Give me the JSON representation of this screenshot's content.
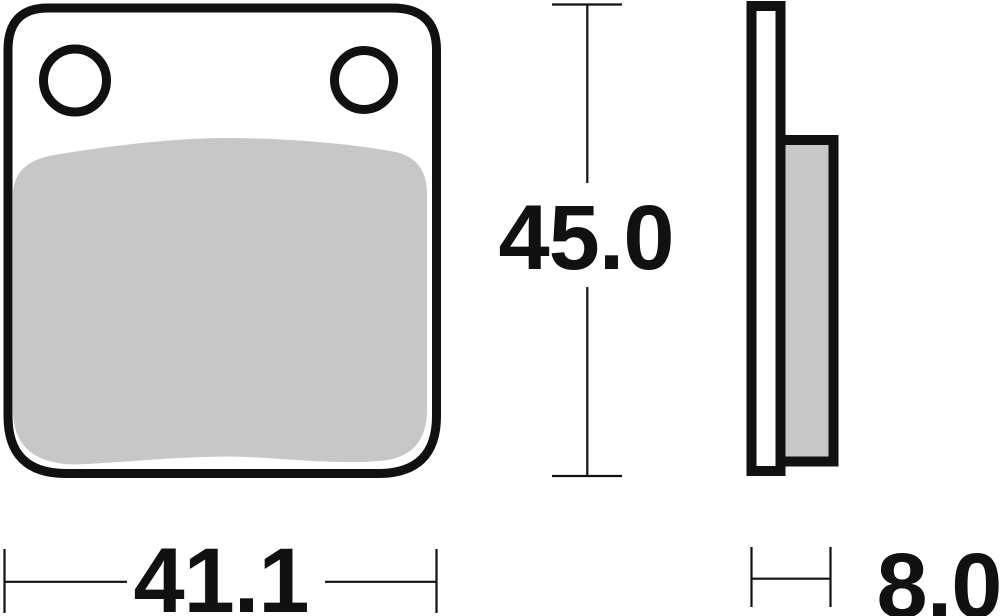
{
  "dimension_labels": {
    "width": "41.1",
    "height": "45.0",
    "thickness": "8.0"
  },
  "colors": {
    "line": "#111111",
    "friction_material": "#c7c7c7",
    "backing_plate": "#ffffff",
    "background": "#ffffff"
  }
}
